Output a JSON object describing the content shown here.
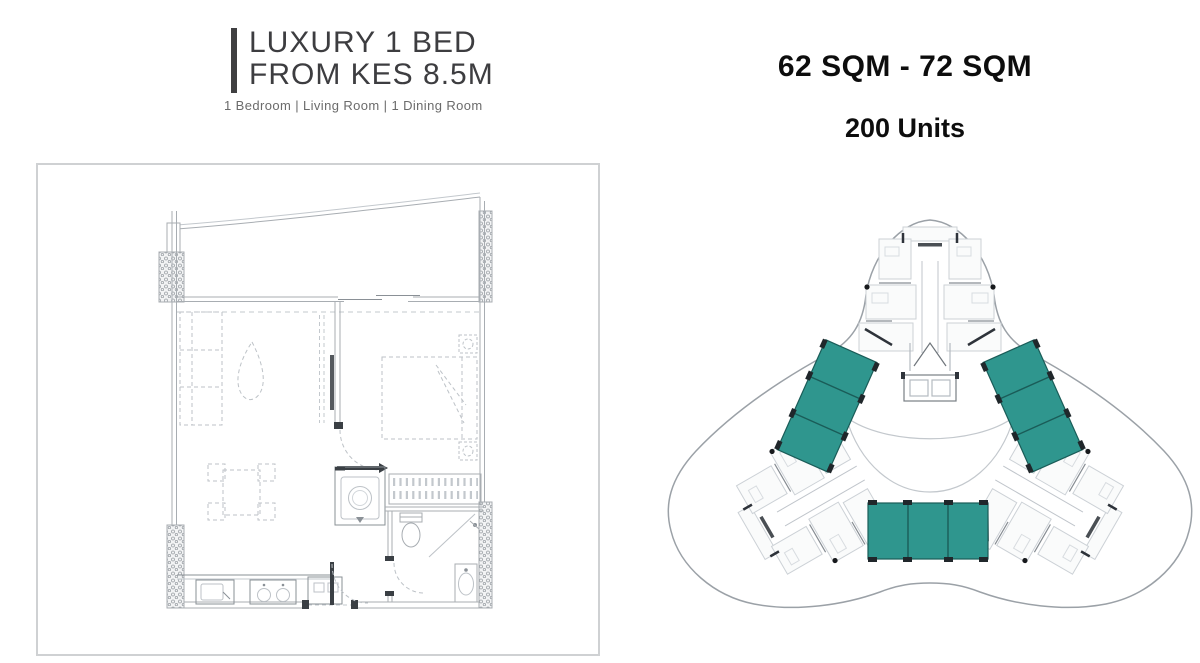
{
  "left_panel": {
    "title_line1": "LUXURY 1 BED",
    "title_line2": "FROM KES 8.5M",
    "subtitle": "1 Bedroom | Living Room | 1 Dining Room"
  },
  "right_panel": {
    "area_range": "62 SQM - 72 SQM",
    "unit_count": "200 Units"
  },
  "colors": {
    "highlight_teal": "#2F968E",
    "highlight_teal_border": "#1A5C58",
    "plan_line_gray": "#A8ADB2",
    "furniture_line_gray": "#BDC2C7",
    "accent_bar": "#3F3F41",
    "title_text": "#3D3D40",
    "subtitle_text": "#6B6B6B",
    "stats_text": "#0D0D0D",
    "frame_border": "#CFD1D3"
  },
  "drawings": {
    "floorplan": "1-bedroom apartment floor plan",
    "floorplate": "tri-lobed tower floor plate with highlighted 1-bed units"
  }
}
